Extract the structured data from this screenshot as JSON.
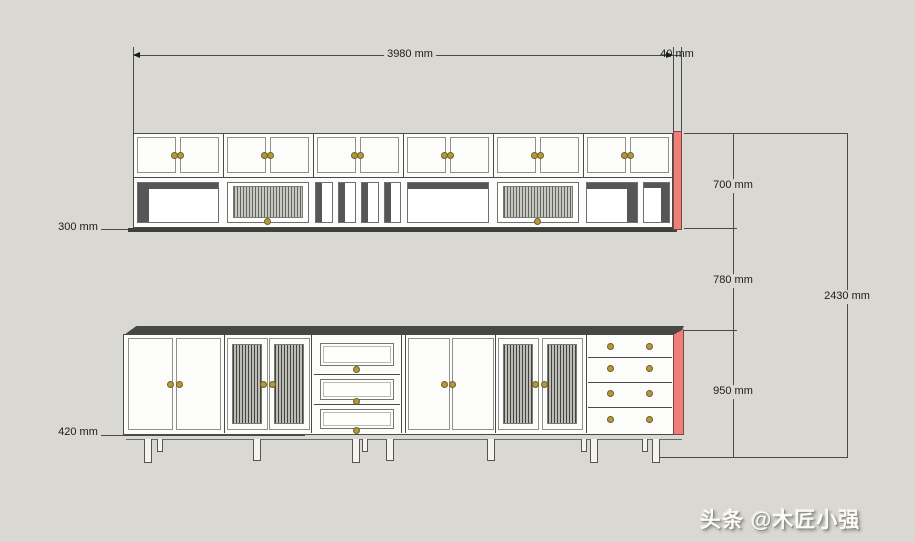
{
  "drawing": {
    "title": "cabinet-elevation-drawing",
    "dimensions": {
      "total_width": "3980 mm",
      "side_panel_thickness": "40 mm",
      "upper_cabinet_height": "700 mm",
      "middle_gap": "780 mm",
      "lower_cabinet_height": "950 mm",
      "total_height": "2430 mm",
      "upper_cabinet_depth": "300 mm",
      "lower_cabinet_depth": "420 mm"
    },
    "colors": {
      "background": "#d9d8d3",
      "line": "#4a4a4a",
      "cabinet_fill": "#fcfcfa",
      "accent_side_panel": "#ee7e78",
      "knob": "#b29a3c",
      "shadow_dark": "#565656"
    },
    "watermark": "头条 @木匠小强"
  }
}
